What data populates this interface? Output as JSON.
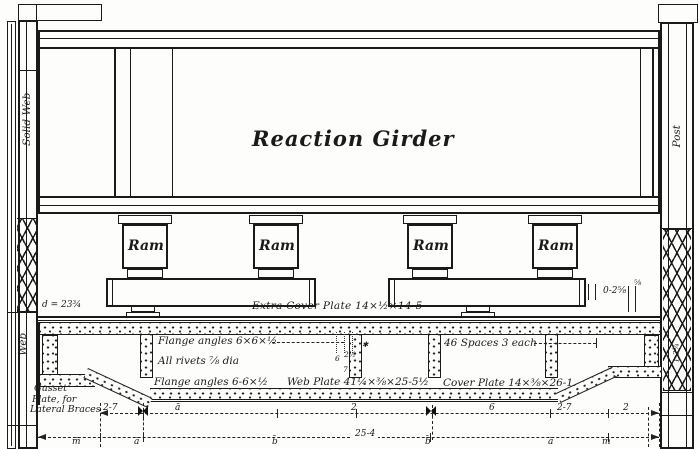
{
  "drawing": {
    "girder_title": "Reaction Girder",
    "left_column_upper": "Solid Web",
    "left_column_lower": "Web",
    "right_column": "Post",
    "right_column_dim": "1-2¾",
    "rams": [
      {
        "label": "Ram"
      },
      {
        "label": "Ram"
      },
      {
        "label": "Ram"
      },
      {
        "label": "Ram"
      }
    ],
    "annotations": {
      "extra_cover_plate": "Extra Cover Plate 14×½×14-5",
      "d_dim": "d = 23¾",
      "flange_angles_top": "Flange angles 6×6×½",
      "rivets_note": "All rivets ⅞ dia",
      "flange_angles_bottom": "Flange angles 6-6×½",
      "web_plate": "Web Plate 41¼×⅜×25-5½",
      "spacing_note": "46 Spaces 3 each",
      "cover_plate": "Cover Plate 14×⅜×26-1",
      "gusset_line1": "Gusset",
      "gusset_line2": "Plate, for",
      "gusset_line3": "Lateral Braces",
      "end_dim": "0-2⅝",
      "end_dim_frac": "⅝",
      "gauge_1": "6",
      "gauge_2": "2½",
      "gauge_3": "7",
      "ref_mark": "✱"
    },
    "dimensions": {
      "upper": [
        {
          "t": "2-7"
        },
        {
          "t": "ā"
        },
        {
          "t": "2"
        },
        {
          "t": "6"
        },
        {
          "t": "2-7"
        },
        {
          "t": "2"
        }
      ],
      "lower": [
        {
          "t": "m̄"
        },
        {
          "t": "ā"
        },
        {
          "t": "b̄"
        },
        {
          "t": "25-4"
        },
        {
          "t": "b̄"
        },
        {
          "t": "ā"
        },
        {
          "t": "m̄"
        }
      ]
    }
  }
}
